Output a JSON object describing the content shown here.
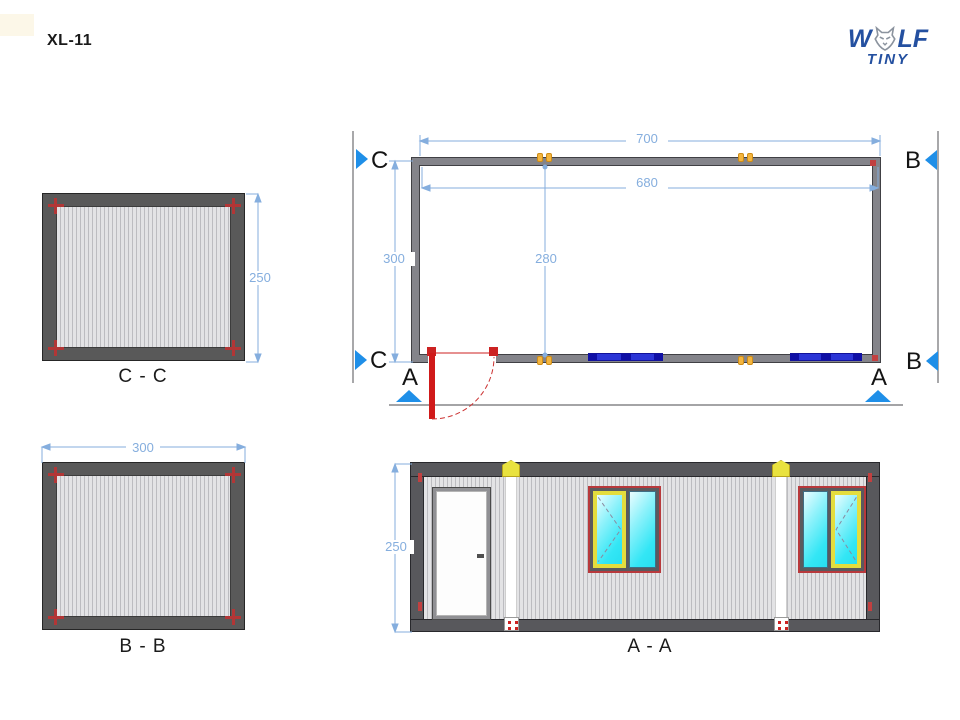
{
  "title": "XL-11",
  "logo": {
    "word_start": "W",
    "word_end": "LF",
    "subtitle": "TINY",
    "wolf_icon": "wolf-head-icon",
    "brand_color": "#2450a0"
  },
  "sections": {
    "c": "C",
    "b": "B",
    "a": "A"
  },
  "views": {
    "cc": {
      "caption": "C - C",
      "dim_height": "250"
    },
    "bb": {
      "caption": "B - B",
      "dim_width": "300"
    },
    "plan": {
      "dim_total_width": "700",
      "dim_inner_width": "680",
      "dim_total_depth": "300",
      "dim_inner_depth": "280"
    },
    "aa": {
      "caption": "A - A",
      "dim_height": "250"
    }
  },
  "colors": {
    "dimension_blue": "#85aede",
    "section_marker_blue": "#1f8fe8",
    "wall_gray": "#84848a",
    "frame_gray": "#595959",
    "door_red": "#cc1a1a",
    "plan_window_blue": "#2b35d6",
    "connector_yellow": "#f4b53e",
    "cap_yellow": "#e9e23f",
    "glass_cyan": "#33e6f5",
    "corner_mark_red": "#b23636"
  }
}
